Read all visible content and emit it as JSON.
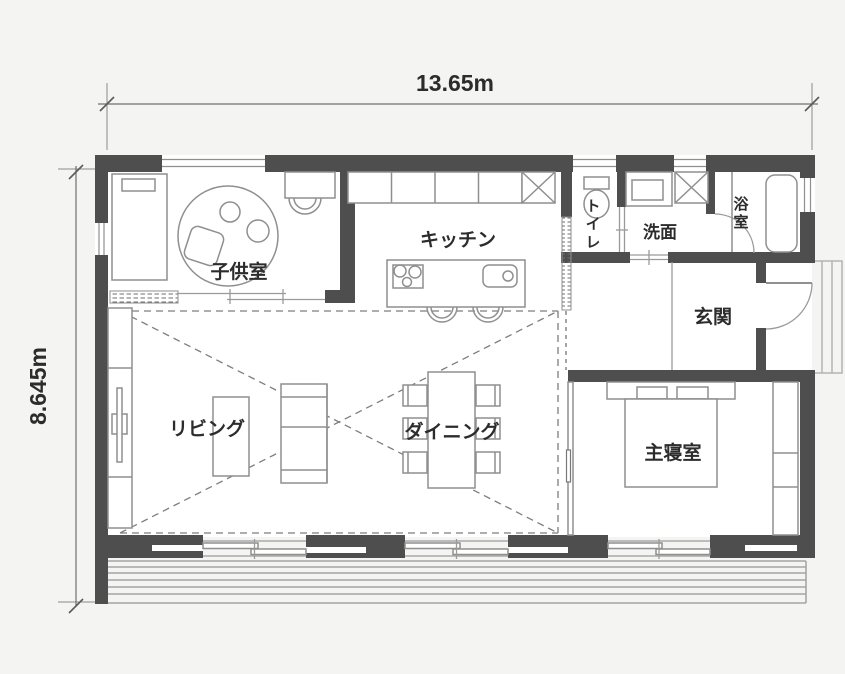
{
  "dimensions": {
    "width_label": "13.65m",
    "height_label": "8.645m"
  },
  "rooms": {
    "kids_room": "子供室",
    "kitchen": "キッチン",
    "toilet": "トイレ",
    "washroom": "洗面",
    "bathroom": "浴室",
    "entrance": "玄関",
    "living": "リビング",
    "dining": "ダイニング",
    "master_bedroom": "主寝室"
  },
  "colors": {
    "background": "#f4f4f2",
    "wall": "#4e4e4e",
    "furniture_line": "#8f8f8f",
    "text": "#2c2c2c"
  }
}
